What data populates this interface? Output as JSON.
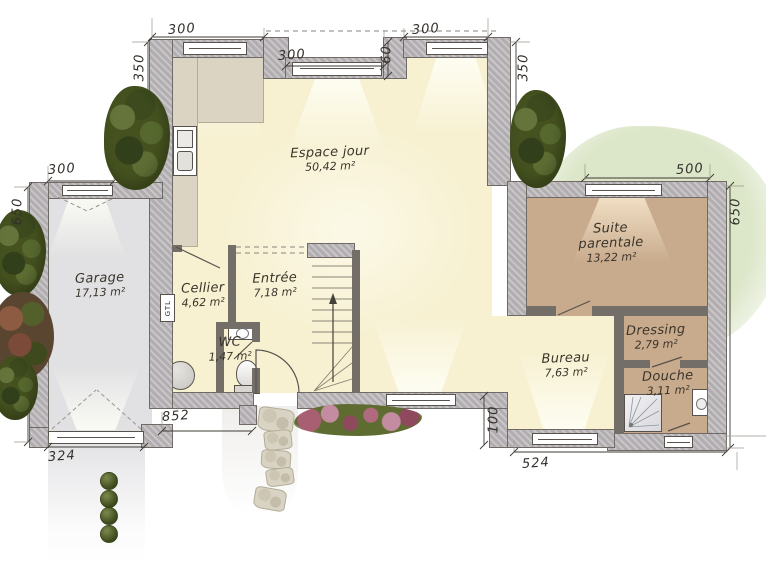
{
  "rooms": {
    "espace_jour": {
      "name": "Espace jour",
      "area": "50,42 m²"
    },
    "garage": {
      "name": "Garage",
      "area": "17,13 m²"
    },
    "cellier": {
      "name": "Cellier",
      "area": "4,62 m²"
    },
    "entree": {
      "name": "Entrée",
      "area": "7,18 m²"
    },
    "wc": {
      "name": "WC",
      "area": "1,47 m²"
    },
    "suite_parentale": {
      "name": "Suite parentale",
      "area": "13,22 m²"
    },
    "dressing": {
      "name": "Dressing",
      "area": "2,79 m²"
    },
    "bureau": {
      "name": "Bureau",
      "area": "7,63 m²"
    },
    "douche": {
      "name": "Douche",
      "area": "3,11 m²"
    }
  },
  "dimensions": {
    "top_window_left": "300",
    "top_window_mid": "300",
    "top_recess_depth": "60",
    "top_window_right": "300",
    "left_wall_upper": "350",
    "right_wall_upper": "350",
    "garage_window": "300",
    "garage_left_wall": "650",
    "suite_window": "500",
    "suite_right_wall": "650",
    "bottom_wall": "852",
    "garage_door": "324",
    "bureau_wall": "524",
    "step_depth": "100"
  },
  "labels": {
    "gtl": "GTL"
  },
  "colors": {
    "wall": "#b3afb2",
    "floor_day": "#f7f1d1",
    "floor_suite": "#c8aa8c",
    "floor_garage": "#e1e1e3",
    "terrace": "#dce6c8",
    "tree": "#45521f"
  }
}
